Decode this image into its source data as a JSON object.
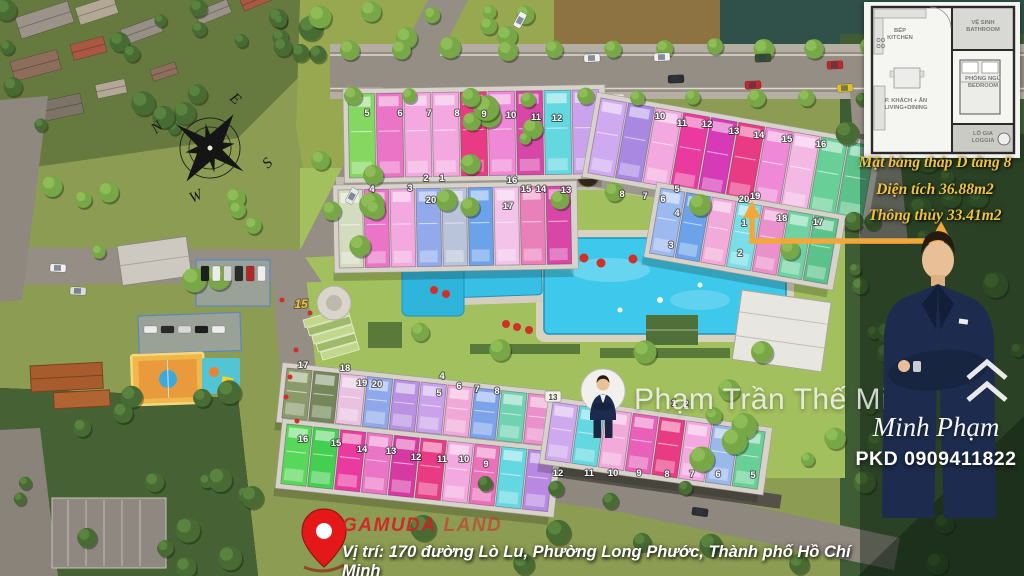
{
  "annotation": {
    "line1": "Mặt bằng tháp D tầng 8",
    "line2": "Diện tích 36.88m2",
    "line3": "Thông thủy 33.41m2"
  },
  "inset_plan": {
    "rooms": {
      "kitchen1": "BẾP",
      "kitchen2": "KITCHEN",
      "bath1": "VỆ SINH",
      "bath2": "BATHROOM",
      "bed1": "PHÒNG NGỦ",
      "bed2": "BEDROOM",
      "living1": "P. KHÁCH + ĂN",
      "living2": "LIVING+DINING",
      "loggia1": "LÔ GIA",
      "loggia2": "LOGGIA"
    }
  },
  "watermark": {
    "name": "Phạm Trần Thế Minh"
  },
  "agent": {
    "signature": "Minh Phạm",
    "phone": "PKD 0909411822"
  },
  "footer": {
    "brand_bold": "GAMUDA",
    "brand_light": "LAND",
    "address": "Vị trí: 170 đường Lò Lu, Phường Long Phước, Thành phố Hồ Chí Minh"
  },
  "compass": {
    "n": "N",
    "e": "E",
    "s": "S",
    "w": "W"
  },
  "colors": {
    "annotation_text": "#f2c33c",
    "arrow": "#f2a73a",
    "brand_red": "#d8232a",
    "pool": "#3ec9ec",
    "highlight_unit": "#7adee8",
    "marker_text": "#ffffff"
  },
  "site": {
    "highlight_unit": "19",
    "special_marker": {
      "x": 301,
      "y": 308,
      "label": "15",
      "color": "#e8c33a"
    },
    "boxed_marker": {
      "x": 553,
      "y": 399,
      "label": "13"
    },
    "wings": [
      {
        "x": 348,
        "y": 94,
        "angle": -1,
        "uw": 28,
        "uh": 84,
        "units": [
          "#84d862",
          "#ea74c6",
          "#f3a9e0",
          "#f3a9e0",
          "#e93a84",
          "#ef88d6",
          "#d846a8",
          "#64d8e0",
          "#cba2ec"
        ]
      },
      {
        "x": 601,
        "y": 98,
        "angle": 10,
        "uw": 28,
        "uh": 76,
        "units": [
          "#d0aaf0",
          "#a988e2",
          "#f3a9e0",
          "#ea3aa0",
          "#d63ab6",
          "#e93a84",
          "#ef88d6",
          "#f3b9e4",
          "#68d096",
          "#5cc28a"
        ]
      },
      {
        "x": 338,
        "y": 190,
        "angle": -1,
        "uw": 26,
        "uh": 78,
        "units": [
          "#d4dcc0",
          "#ea74c6",
          "#f3a9e0",
          "#92aaec",
          "#b9c3d9",
          "#6ca2ea",
          "#f3c3ea",
          "#ea80ba",
          "#d846a8"
        ]
      },
      {
        "x": 661,
        "y": 188,
        "angle": 10,
        "uw": 26,
        "uh": 66,
        "units": [
          "#9cbaf0",
          "#6ca2ea",
          "#f2aada",
          "#7adee8",
          "#ea90ca",
          "#70d2a2",
          "#5ac28a"
        ]
      },
      {
        "x": 287,
        "y": 368,
        "angle": 6,
        "uw": 27,
        "uh": 50,
        "units": [
          "#8a9a6a",
          "#75875a",
          "#e8c2e0",
          "#8fa8ea",
          "#b990e2",
          "#caa2ec",
          "#f0a8d8",
          "#7ca2ea",
          "#70d2b2",
          "#ea90ca"
        ]
      },
      {
        "x": 287,
        "y": 424,
        "angle": 6,
        "uw": 27,
        "uh": 60,
        "units": [
          "#58d858",
          "#44cf50",
          "#ea3aa0",
          "#ea74c6",
          "#d63aa2",
          "#e93a84",
          "#f3a9e0",
          "#ea70ba",
          "#64d8e0",
          "#b988e2"
        ]
      },
      {
        "x": 553,
        "y": 402,
        "angle": 8,
        "uw": 27,
        "uh": 58,
        "units": [
          "#cfa9ee",
          "#64d8e0",
          "#f2aada",
          "#e860b8",
          "#e93a84",
          "#f3a9e0",
          "#9ab8ea",
          "#68cf96"
        ]
      }
    ],
    "markers": [
      {
        "x": 367,
        "y": 116,
        "n": "5"
      },
      {
        "x": 400,
        "y": 116,
        "n": "6"
      },
      {
        "x": 429,
        "y": 116,
        "n": "7"
      },
      {
        "x": 457,
        "y": 116,
        "n": "8"
      },
      {
        "x": 484,
        "y": 117,
        "n": "9"
      },
      {
        "x": 511,
        "y": 118,
        "n": "10"
      },
      {
        "x": 536,
        "y": 120,
        "n": "11"
      },
      {
        "x": 557,
        "y": 121,
        "n": "12"
      },
      {
        "x": 372,
        "y": 192,
        "n": "4"
      },
      {
        "x": 410,
        "y": 191,
        "n": "3"
      },
      {
        "x": 426,
        "y": 181,
        "n": "2"
      },
      {
        "x": 442,
        "y": 181,
        "n": "1"
      },
      {
        "x": 431,
        "y": 203,
        "n": "20"
      },
      {
        "x": 512,
        "y": 183,
        "n": "16"
      },
      {
        "x": 526,
        "y": 192,
        "n": "15"
      },
      {
        "x": 541,
        "y": 192,
        "n": "14"
      },
      {
        "x": 566,
        "y": 193,
        "n": "13"
      },
      {
        "x": 508,
        "y": 209,
        "n": "17"
      },
      {
        "x": 660,
        "y": 119,
        "n": "10"
      },
      {
        "x": 682,
        "y": 126,
        "n": "11"
      },
      {
        "x": 707,
        "y": 127,
        "n": "12"
      },
      {
        "x": 734,
        "y": 134,
        "n": "13"
      },
      {
        "x": 759,
        "y": 138,
        "n": "14"
      },
      {
        "x": 787,
        "y": 142,
        "n": "15"
      },
      {
        "x": 821,
        "y": 147,
        "n": "16"
      },
      {
        "x": 622,
        "y": 197,
        "n": "8"
      },
      {
        "x": 645,
        "y": 199,
        "n": "7"
      },
      {
        "x": 663,
        "y": 202,
        "n": "6"
      },
      {
        "x": 677,
        "y": 192,
        "n": "5"
      },
      {
        "x": 677,
        "y": 216,
        "n": "4"
      },
      {
        "x": 671,
        "y": 248,
        "n": "3"
      },
      {
        "x": 744,
        "y": 202,
        "n": "20"
      },
      {
        "x": 755,
        "y": 199,
        "n": "19"
      },
      {
        "x": 782,
        "y": 221,
        "n": "18"
      },
      {
        "x": 818,
        "y": 225,
        "n": "17"
      },
      {
        "x": 744,
        "y": 226,
        "n": "1"
      },
      {
        "x": 740,
        "y": 256,
        "n": "2"
      },
      {
        "x": 303,
        "y": 368,
        "n": "17"
      },
      {
        "x": 345,
        "y": 371,
        "n": "18"
      },
      {
        "x": 362,
        "y": 386,
        "n": "19"
      },
      {
        "x": 377,
        "y": 387,
        "n": "20"
      },
      {
        "x": 442,
        "y": 379,
        "n": "4"
      },
      {
        "x": 439,
        "y": 396,
        "n": "5"
      },
      {
        "x": 459,
        "y": 389,
        "n": "6"
      },
      {
        "x": 477,
        "y": 392,
        "n": "7"
      },
      {
        "x": 497,
        "y": 394,
        "n": "8"
      },
      {
        "x": 303,
        "y": 442,
        "n": "16"
      },
      {
        "x": 336,
        "y": 446,
        "n": "15"
      },
      {
        "x": 362,
        "y": 452,
        "n": "14"
      },
      {
        "x": 391,
        "y": 454,
        "n": "13"
      },
      {
        "x": 416,
        "y": 460,
        "n": "12"
      },
      {
        "x": 442,
        "y": 462,
        "n": "11"
      },
      {
        "x": 464,
        "y": 462,
        "n": "10"
      },
      {
        "x": 486,
        "y": 467,
        "n": "9"
      },
      {
        "x": 674,
        "y": 406,
        "n": "1"
      },
      {
        "x": 686,
        "y": 407,
        "n": "2"
      },
      {
        "x": 558,
        "y": 476,
        "n": "12"
      },
      {
        "x": 589,
        "y": 476,
        "n": "11"
      },
      {
        "x": 613,
        "y": 476,
        "n": "10"
      },
      {
        "x": 639,
        "y": 476,
        "n": "9"
      },
      {
        "x": 667,
        "y": 477,
        "n": "8"
      },
      {
        "x": 692,
        "y": 477,
        "n": "7"
      },
      {
        "x": 718,
        "y": 477,
        "n": "6"
      },
      {
        "x": 753,
        "y": 478,
        "n": "5"
      }
    ]
  }
}
